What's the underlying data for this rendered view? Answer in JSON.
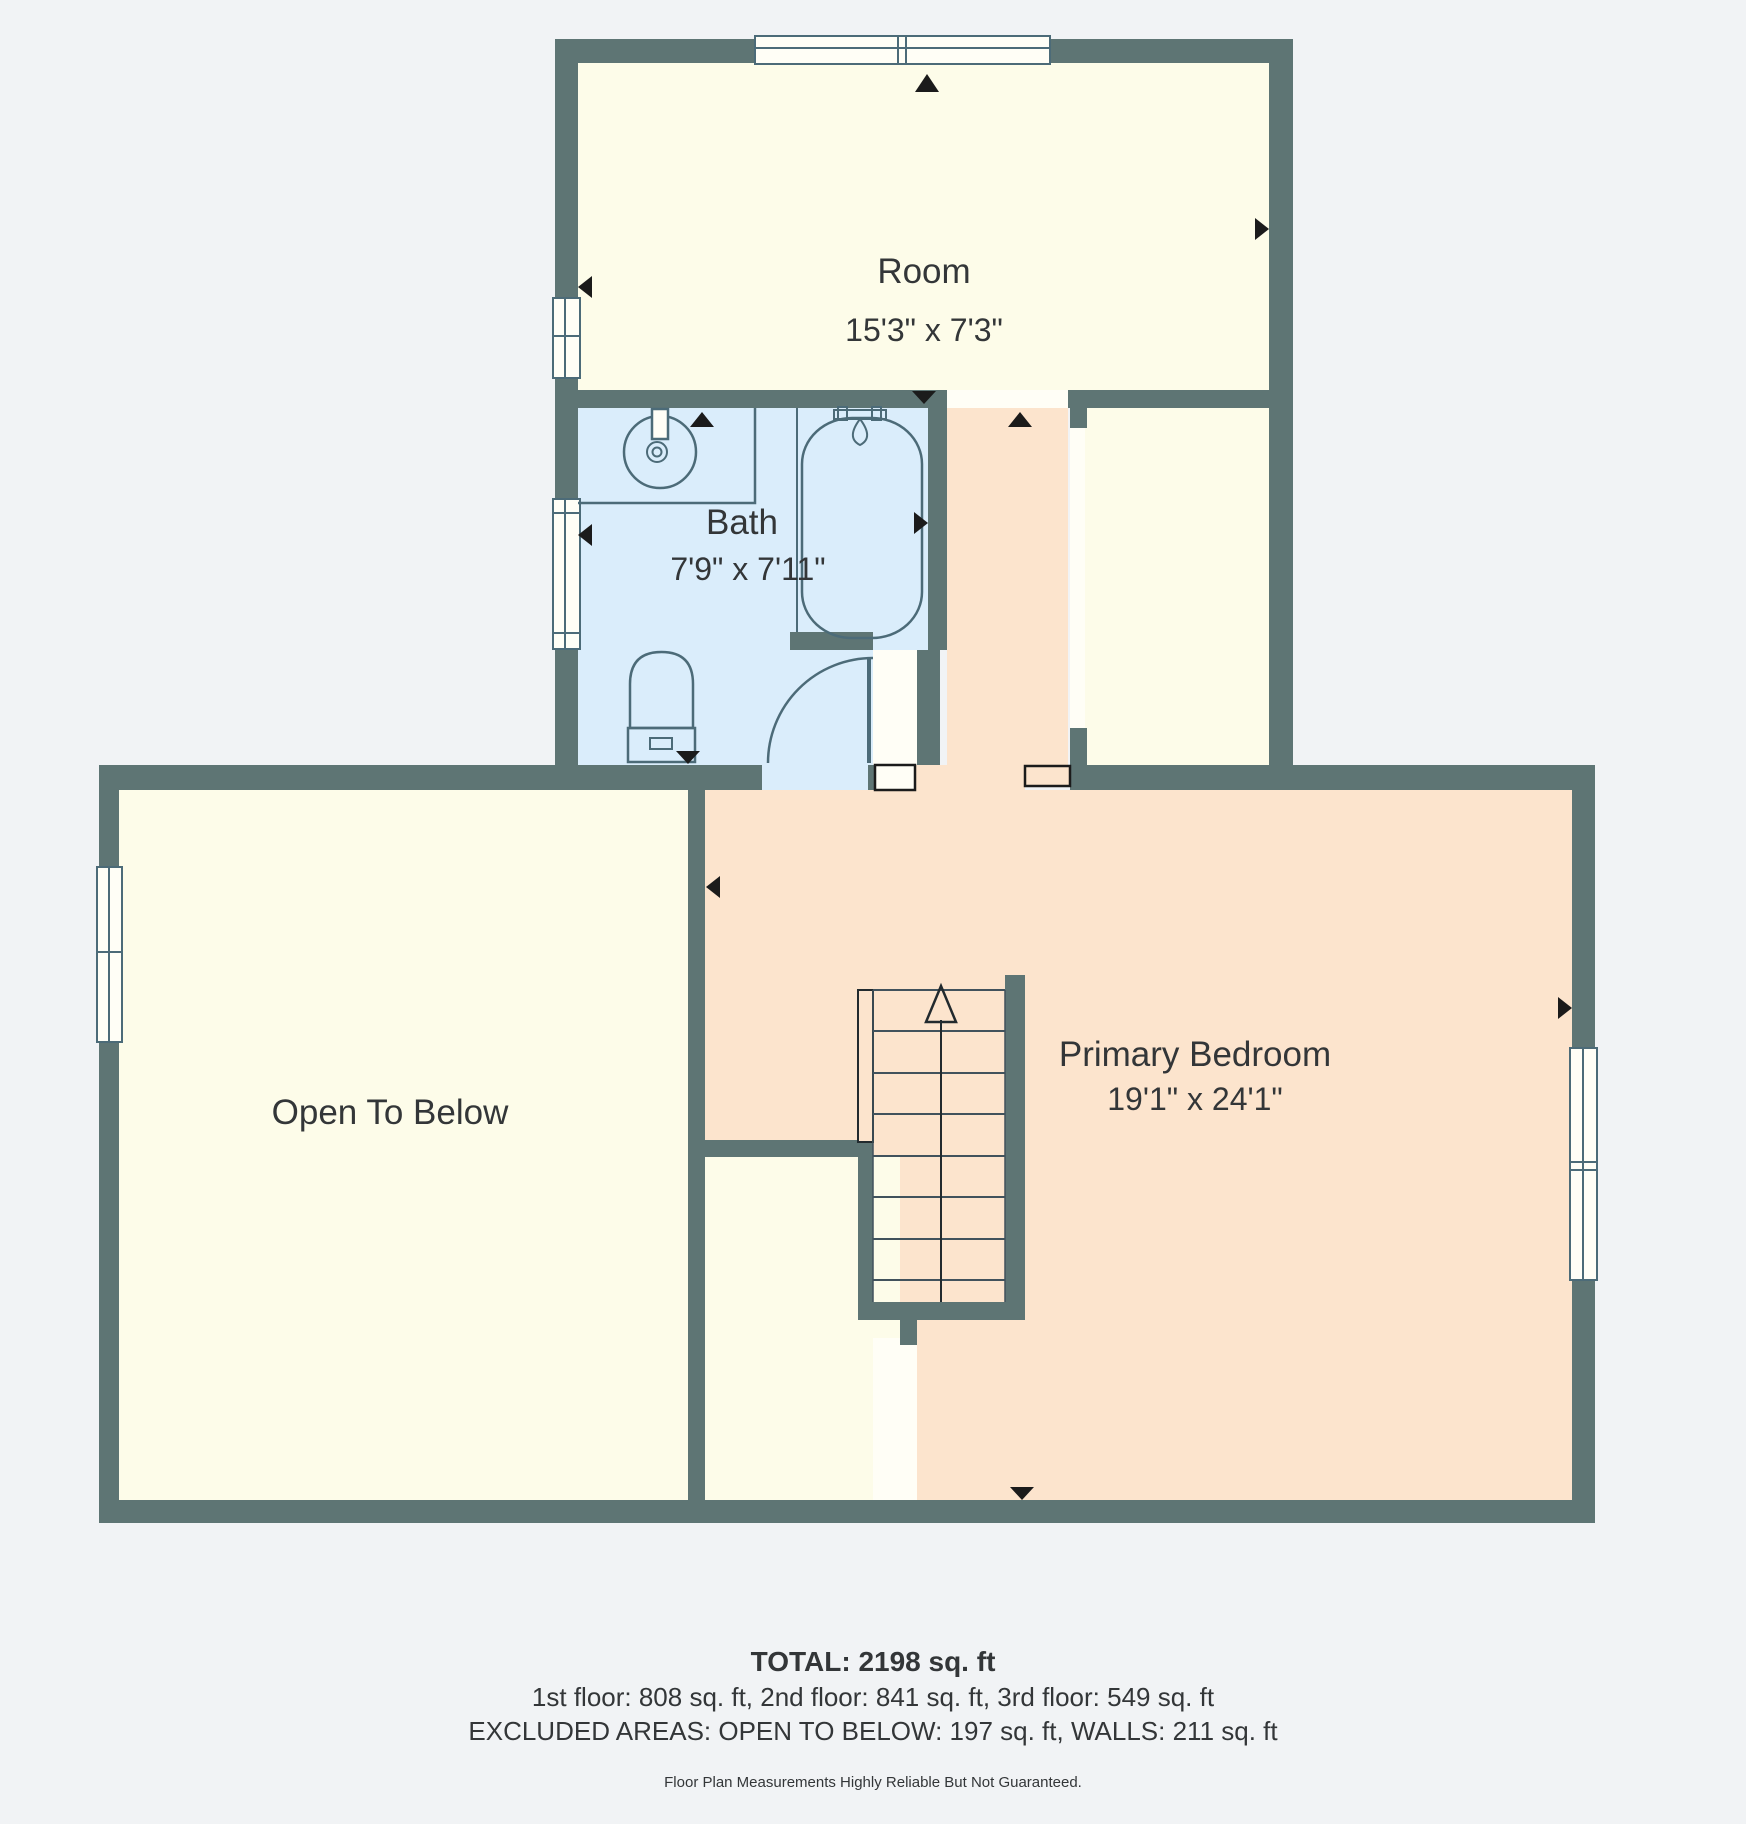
{
  "rooms": {
    "room": {
      "label": "Room",
      "dimensions": "15'3\" x 7'3\""
    },
    "bath": {
      "label": "Bath",
      "dimensions": "7'9\" x 7'11\""
    },
    "open_to_below": {
      "label": "Open To Below"
    },
    "primary_bedroom": {
      "label": "Primary Bedroom",
      "dimensions": "19'1\" x 24'1\""
    }
  },
  "summary": {
    "total": "TOTAL: 2198 sq. ft",
    "floors": "1st floor: 808 sq. ft, 2nd floor: 841 sq. ft, 3rd floor: 549 sq. ft",
    "excluded": "EXCLUDED AREAS: OPEN TO BELOW: 197 sq. ft, WALLS: 211 sq. ft",
    "disclaimer": "Floor Plan Measurements Highly Reliable But Not Guaranteed."
  },
  "colors": {
    "background": "#f1f3f5",
    "wall": "#5e7574",
    "room_fill": "#fdfce9",
    "bath_fill": "#daedfb",
    "bedroom_fill": "#fce4cd",
    "opening_fill": "#fffef6",
    "fixture_line": "#4c6b78",
    "arrow": "#1b1b1b",
    "text": "#333638"
  }
}
